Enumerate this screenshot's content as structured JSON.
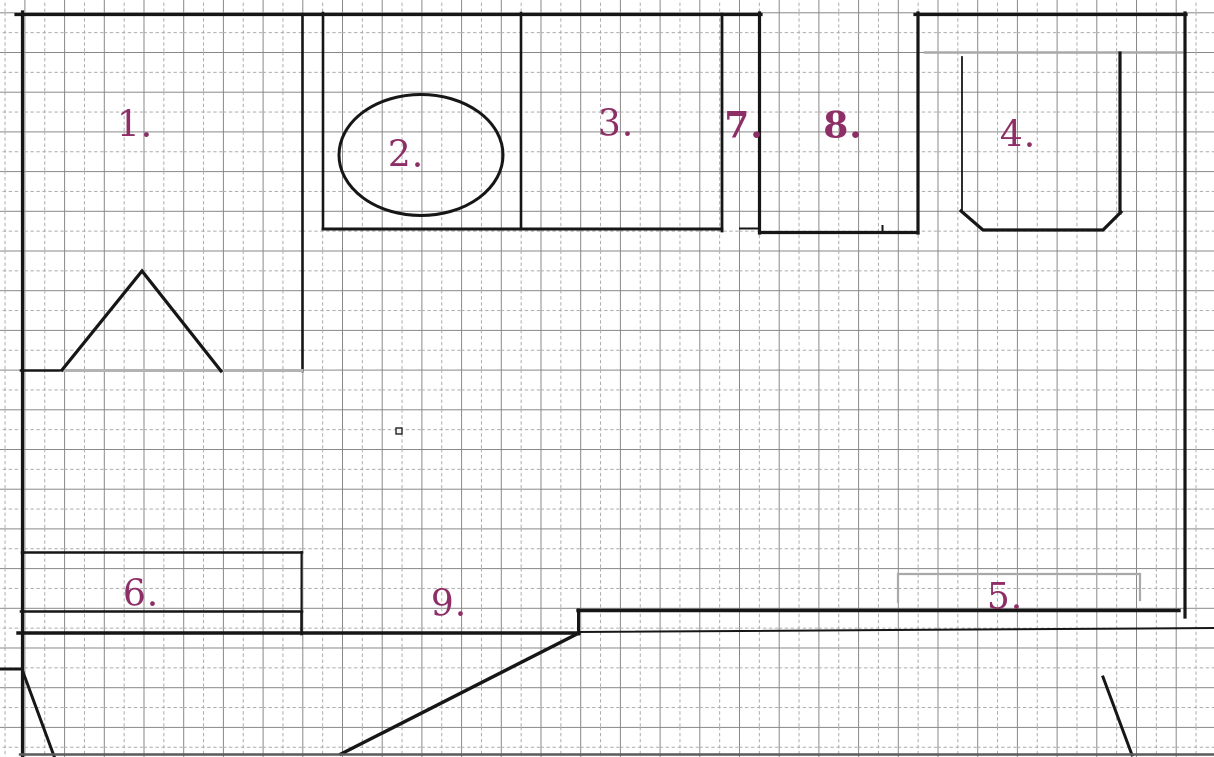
{
  "drawing": {
    "type": "floor-plan-on-grid-paper",
    "room_numbers": [
      "1.",
      "2.",
      "3.",
      "4.",
      "5.",
      "6.",
      "7.",
      "8.",
      "9."
    ]
  },
  "labels": [
    {
      "id": "1",
      "text": "1.",
      "x": 135,
      "y": 127,
      "bold": false
    },
    {
      "id": "2",
      "text": "2.",
      "x": 406,
      "y": 157,
      "bold": false
    },
    {
      "id": "3",
      "text": "3.",
      "x": 616,
      "y": 126,
      "bold": false
    },
    {
      "id": "4",
      "text": "4.",
      "x": 1018,
      "y": 137,
      "bold": false
    },
    {
      "id": "5",
      "text": "5.",
      "x": 1005,
      "y": 599,
      "bold": false
    },
    {
      "id": "6",
      "text": "6.",
      "x": 141,
      "y": 596,
      "bold": false
    },
    {
      "id": "7",
      "text": "7.",
      "x": 744,
      "y": 127,
      "bold": true
    },
    {
      "id": "8",
      "text": "8.",
      "x": 843,
      "y": 127,
      "bold": true
    },
    {
      "id": "9",
      "text": "9.",
      "x": 449,
      "y": 606,
      "bold": false
    }
  ],
  "colors": {
    "label": "#8e2e66",
    "wall": "#161616",
    "grid_major": "#878787",
    "grid_minor": "#ababab",
    "gray_accent": "#a9a9a9",
    "triangle_base_gray": "#b3b3b3",
    "bottom_edge": "#5a5a5a"
  }
}
